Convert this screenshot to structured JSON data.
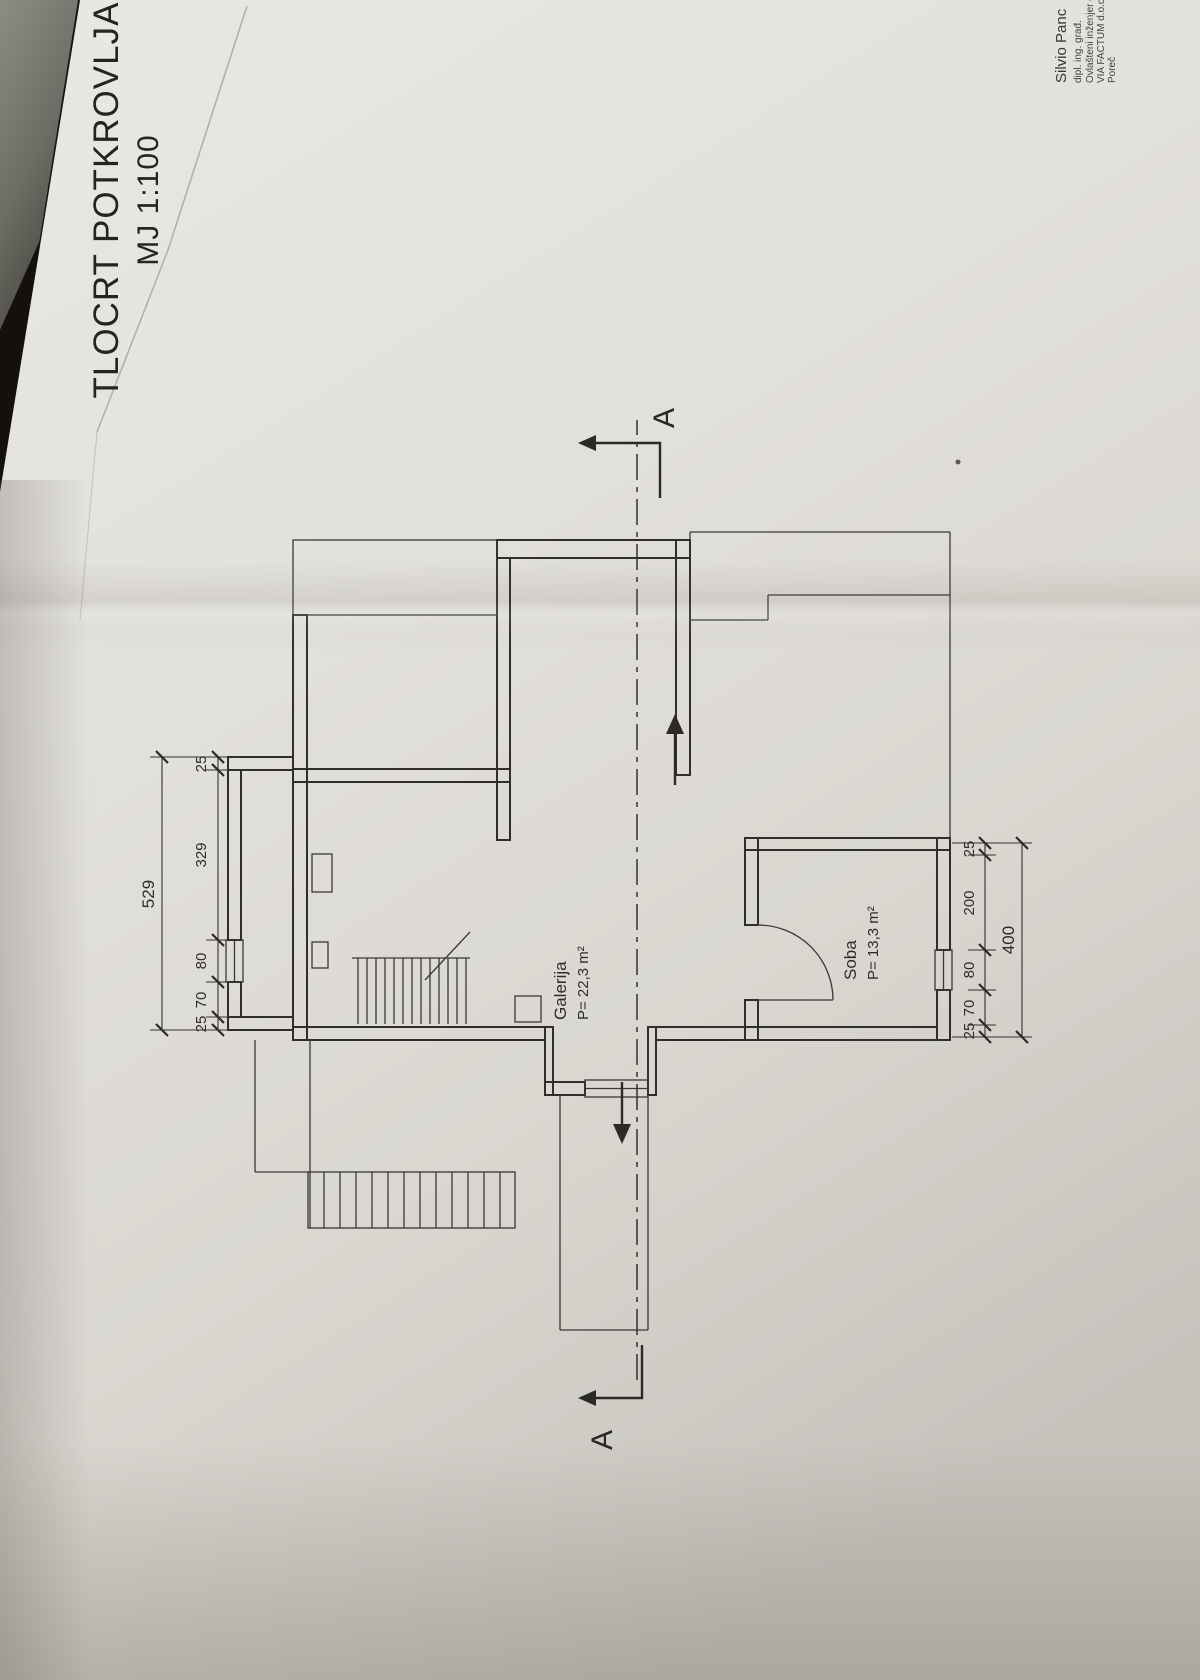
{
  "title": {
    "line1": "TLOCRT POTKROVLJA",
    "line2": "MJ 1:100"
  },
  "rooms": {
    "galerija": {
      "name": "Galerija",
      "area": "P= 22,3 m²"
    },
    "soba": {
      "name": "Soba",
      "area": "P= 13,3 m²"
    }
  },
  "section": {
    "start_label": "A",
    "end_label": "A"
  },
  "dimensions": {
    "top_chain": {
      "total": "529",
      "segments": [
        "25",
        "70",
        "80",
        "329",
        "25"
      ]
    },
    "bottom_chain": {
      "total": "400",
      "segments": [
        "25",
        "70",
        "80",
        "200",
        "25"
      ]
    }
  },
  "signature": {
    "lines": [
      "Silvio Panc",
      "dipl. ing. građ.",
      "Ovlašteni inženjer građ.",
      "VIA FACTUM d.o.o.",
      "Poreč"
    ]
  },
  "colors": {
    "paper": "#e3e1dc",
    "ink": "#302e2a",
    "background": "#17140f"
  }
}
